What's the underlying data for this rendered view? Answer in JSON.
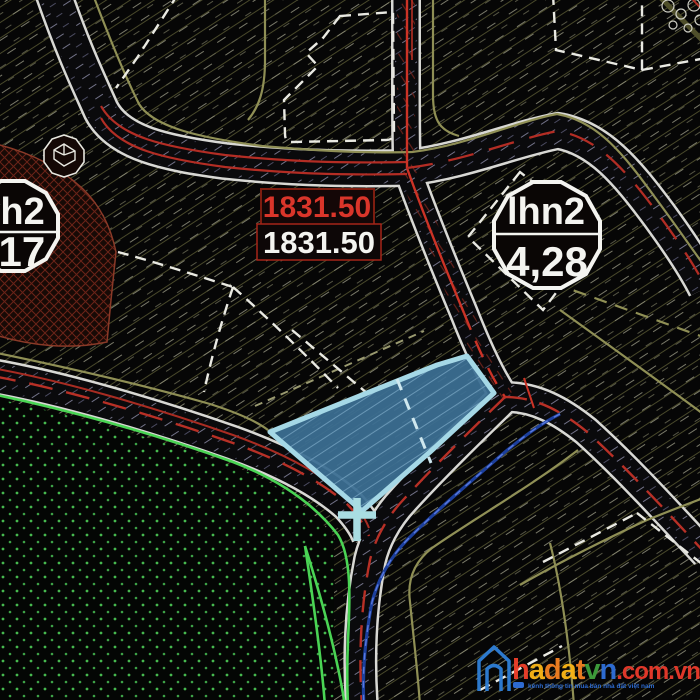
{
  "map": {
    "zone_labels": {
      "left": {
        "code": "vh2",
        "value": ",17"
      },
      "right": {
        "code": "lhn2",
        "value": "4,28"
      }
    },
    "elevation_labels": {
      "primary": "1831.50",
      "secondary": "1831.50"
    }
  },
  "watermark": {
    "letters": [
      {
        "ch": "h",
        "color": "#ee3f2a"
      },
      {
        "ch": "a",
        "color": "#f9b517"
      },
      {
        "ch": "d",
        "color": "#f28022"
      },
      {
        "ch": "a",
        "color": "#f9b517"
      },
      {
        "ch": "t",
        "color": "#f28022"
      },
      {
        "ch": "v",
        "color": "#3fa03c"
      },
      {
        "ch": "n",
        "color": "#2f6fd8"
      }
    ],
    "suffix": ".com.vn",
    "suffix_color": "#e8392b",
    "house_color": "#2e7ed6",
    "tagline": "kênh thông tin mua bán nhà đất việt nam",
    "tagline_color": "#2f6fd8"
  },
  "colors": {
    "selected_parcel_fill": "#3c6f93",
    "selected_parcel_border": "#a5d8e6",
    "marker": "#a9dde2",
    "road_edge": "#d8d8d4",
    "center_line_red": "#c03328",
    "boundary_khaki": "#8f8f55",
    "boundary_dashed_white": "#e9e9e2",
    "green_boundary": "#4ad454",
    "utility_blue": "#1c3f9c"
  }
}
